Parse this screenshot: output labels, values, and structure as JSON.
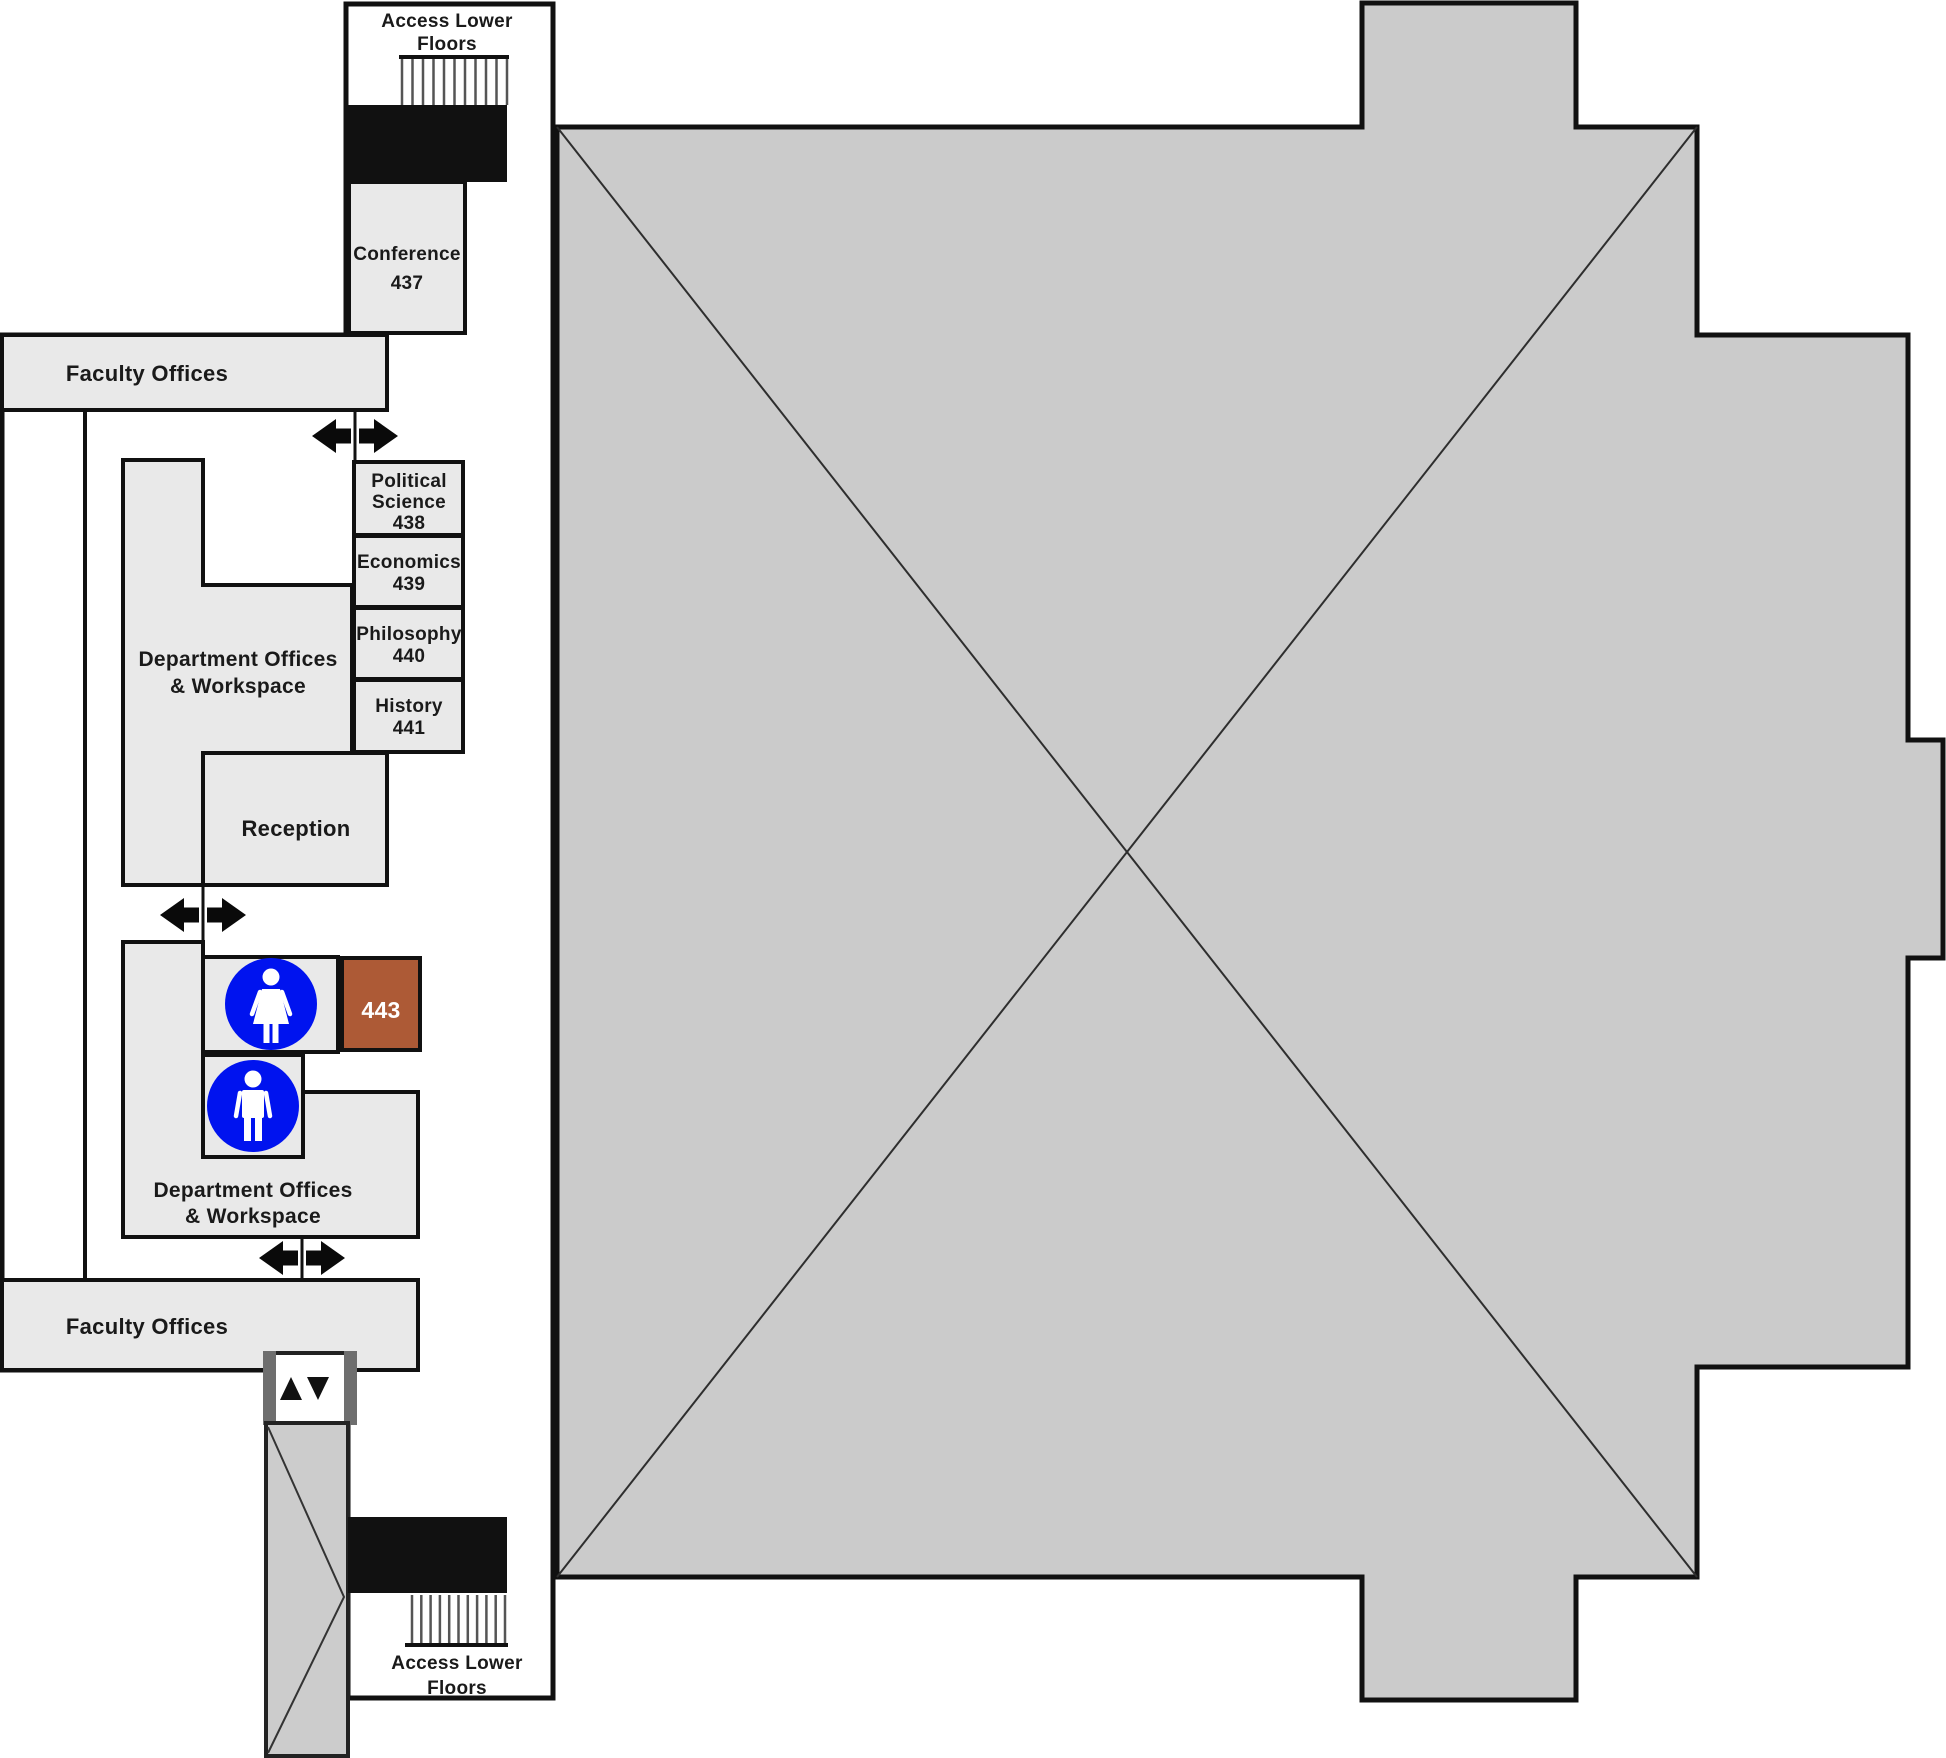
{
  "floorplan": {
    "colors": {
      "open_area_fill": "#cbcbcb",
      "room_fill": "#e9e9e9",
      "accent_room_fill": "#ad5a36",
      "restroom_blue": "#0013ef",
      "wall": "#111111"
    },
    "stairs_top": {
      "line1": "Access Lower",
      "line2": "Floors"
    },
    "stairs_bottom": {
      "line1": "Access Lower",
      "line2": "Floors"
    },
    "rooms": {
      "conference": {
        "line1": "Conference",
        "number": "437"
      },
      "faculty_top": {
        "label": "Faculty Offices"
      },
      "faculty_bottom": {
        "label": "Faculty Offices"
      },
      "political_science": {
        "line1": "Political",
        "line2": "Science",
        "number": "438"
      },
      "economics": {
        "line1": "Economics",
        "number": "439"
      },
      "philosophy": {
        "line1": "Philosophy",
        "number": "440"
      },
      "history": {
        "line1": "History",
        "number": "441"
      },
      "dept_upper": {
        "line1": "Department Offices",
        "line2": "& Workspace"
      },
      "reception": {
        "label": "Reception"
      },
      "dept_lower": {
        "line1": "Department Offices",
        "line2": "& Workspace"
      },
      "room_443": {
        "number": "443"
      }
    },
    "icons": {
      "women_restroom": "women-restroom-icon",
      "men_restroom": "men-restroom-icon",
      "elevator": "elevator-up-down-icon",
      "stairs": "stairs-icon",
      "passage": "double-arrow-passage-icon"
    }
  }
}
